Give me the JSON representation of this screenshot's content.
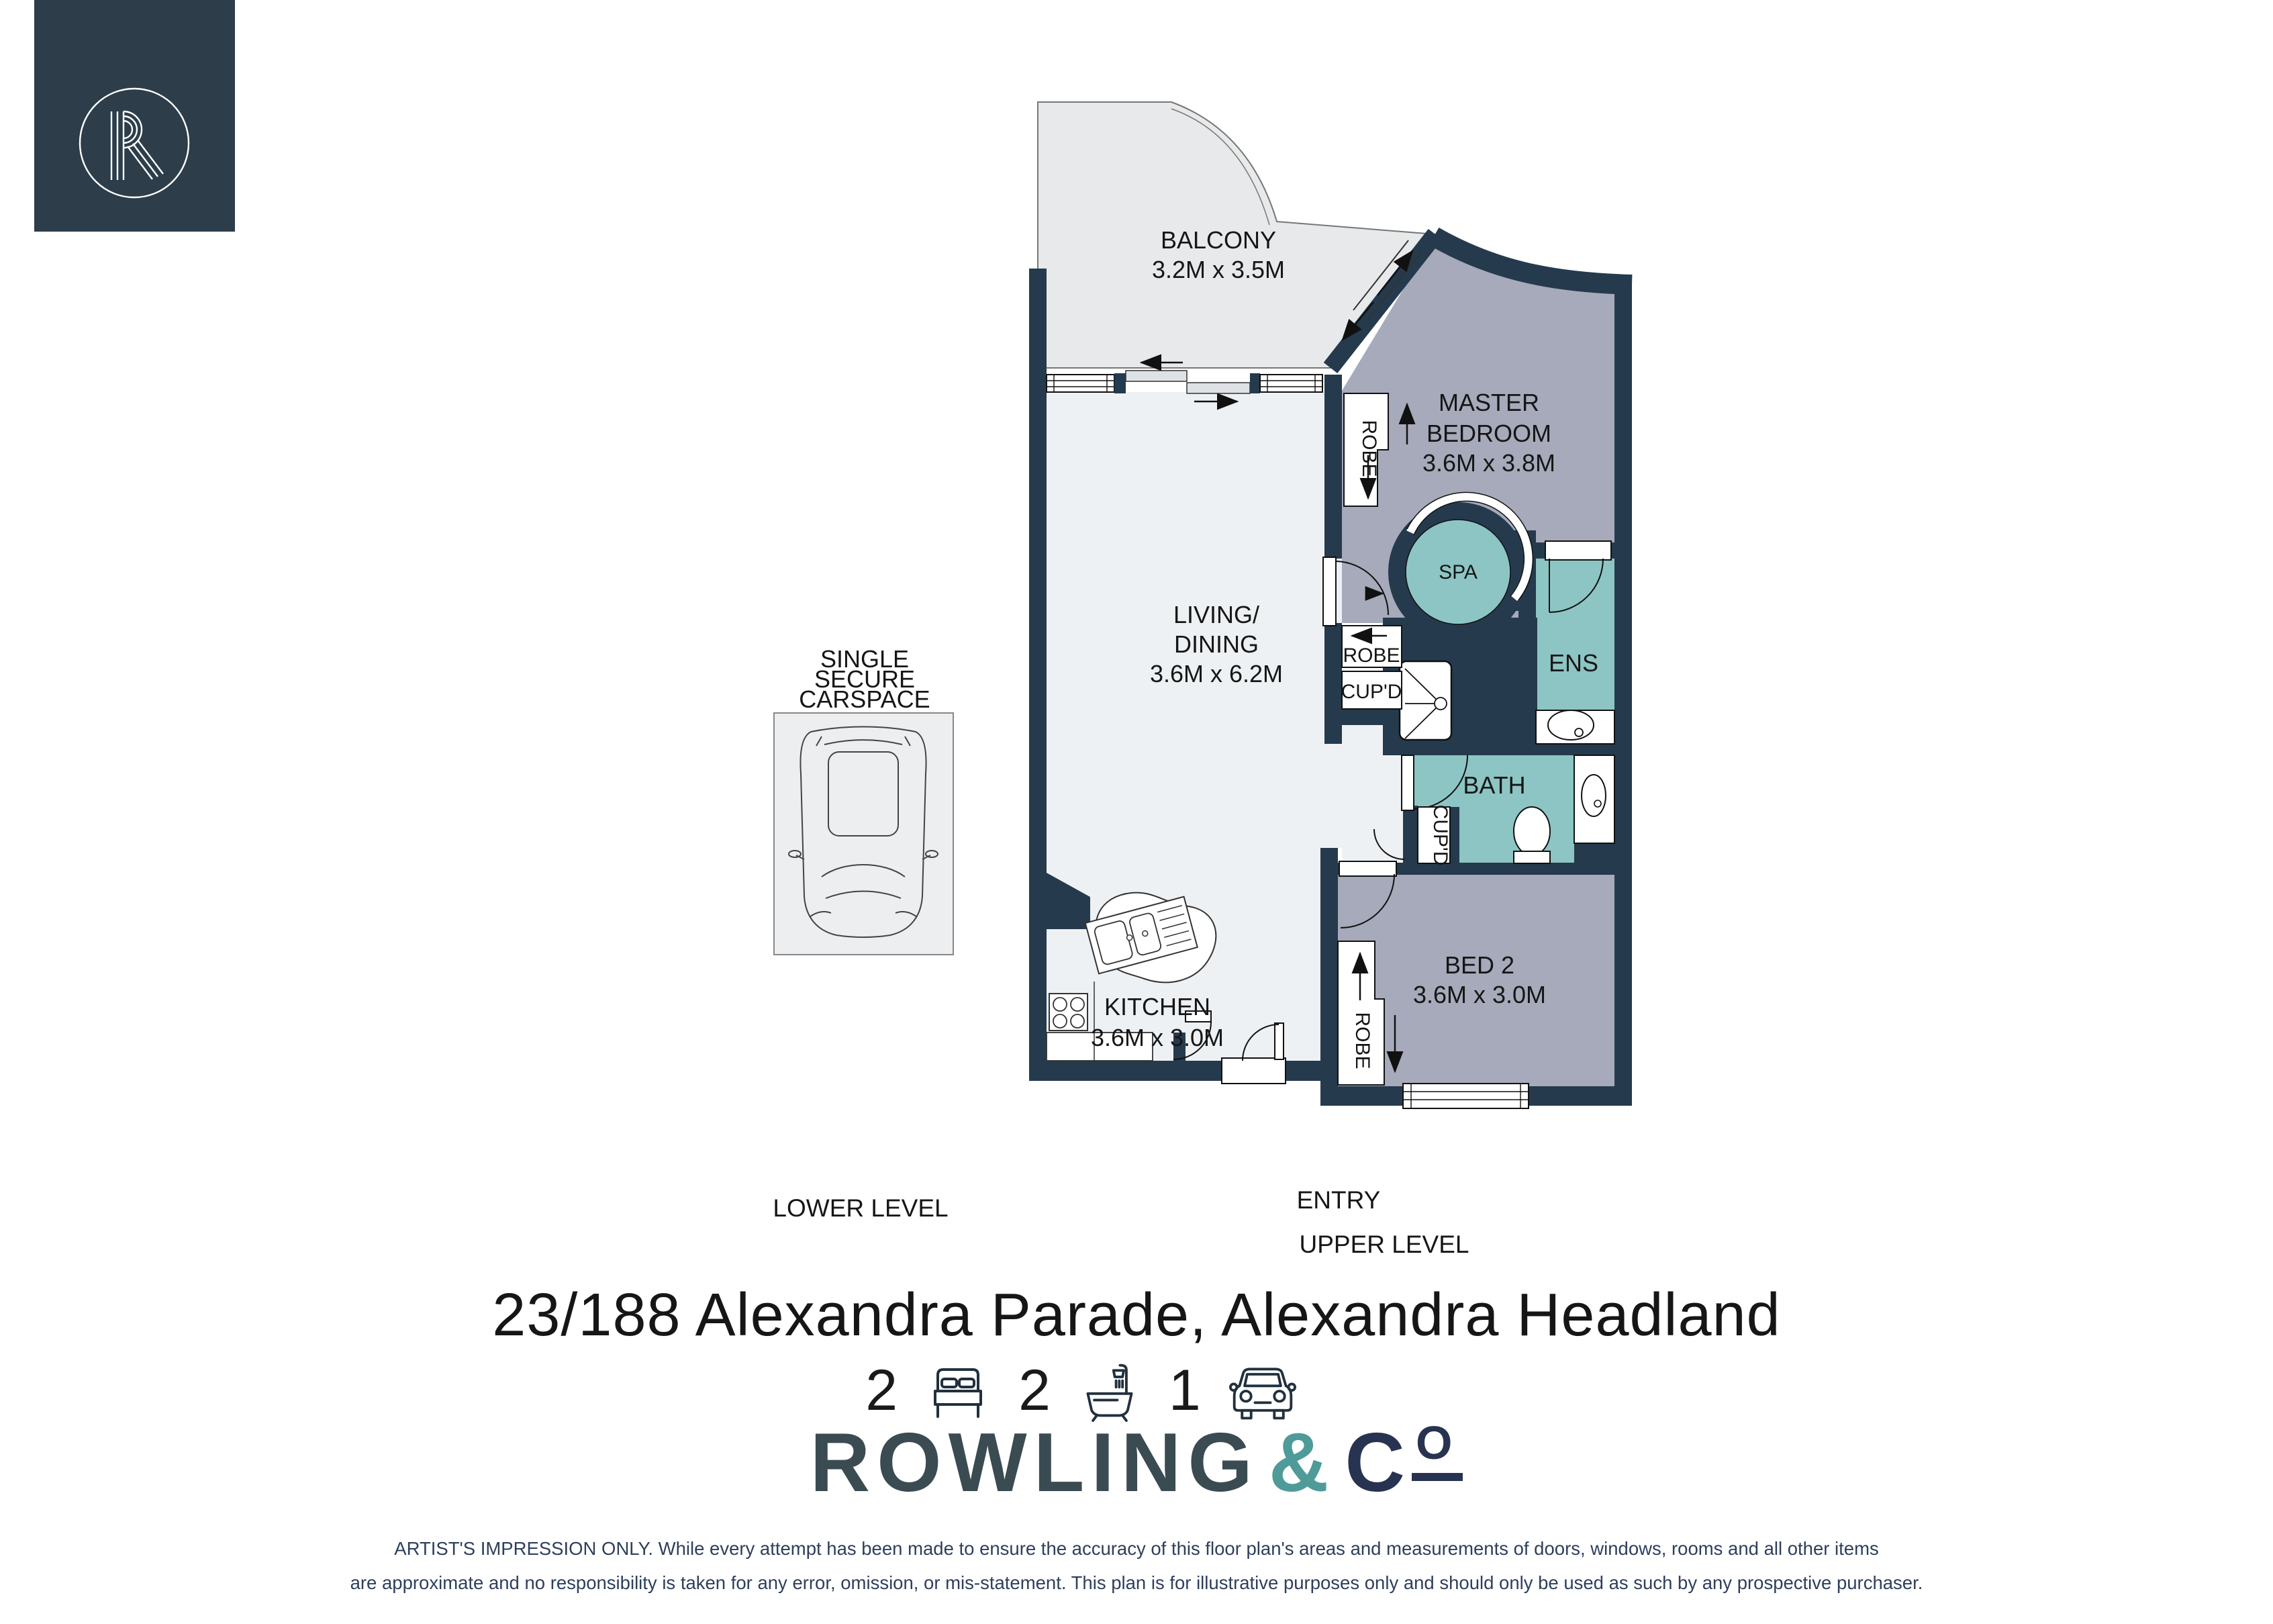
{
  "brand": {
    "logo_letter": "R",
    "wordmark": {
      "primary": "ROWLING",
      "ampersand": "&",
      "c": "C",
      "o": "O"
    }
  },
  "address": "23/188 Alexandra Parade, Alexandra Headland",
  "stats": {
    "beds": {
      "value": "2",
      "icon": "bed-icon"
    },
    "baths": {
      "value": "2",
      "icon": "bath-icon"
    },
    "cars": {
      "value": "1",
      "icon": "car-icon"
    }
  },
  "floor_plan": {
    "rooms": {
      "balcony": {
        "name": "BALCONY",
        "dims": "3.2M x 3.5M"
      },
      "living_dining": {
        "name_line1": "LIVING/",
        "name_line2": "DINING",
        "dims": "3.6M x 6.2M"
      },
      "master_bedroom": {
        "name_line1": "MASTER",
        "name_line2": "BEDROOM",
        "dims": "3.6M x 3.8M"
      },
      "spa": {
        "name": "SPA"
      },
      "ensuite": {
        "name": "ENS"
      },
      "bathroom": {
        "name": "BATH"
      },
      "bed2": {
        "name": "BED 2",
        "dims": "3.6M x 3.0M"
      },
      "kitchen": {
        "name": "KITCHEN",
        "dims": "3.6M x 3.0M"
      }
    },
    "storage": {
      "robe_master": "ROBE",
      "robe_hall": "ROBE",
      "cupd_hall": "CUP'D",
      "cupd_bath": "CUP'D",
      "robe_bed2": "ROBE"
    },
    "annotations": {
      "entry": "ENTRY",
      "upper_level": "UPPER LEVEL",
      "lower_level": "LOWER LEVEL",
      "carspace_line1": "SINGLE",
      "carspace_line2": "SECURE",
      "carspace_line3": "CARSPACE"
    },
    "colors": {
      "wall": "#253a4d",
      "balcony": "#e7e9ea",
      "living": "#eef1f3",
      "bedroom": "#a6aaba",
      "wet_area": "#8cc5c4",
      "fixture": "#ffffff",
      "logo_box": "#2d3d4a"
    }
  },
  "disclaimer": {
    "line1": "ARTIST'S IMPRESSION ONLY. While every attempt has been made to ensure the accuracy of this floor plan's areas and measurements of doors, windows, rooms and all other items",
    "line2": "are approximate and no responsibility is taken for any error, omission, or mis-statement. This plan is for illustrative purposes only and should only be used as such by any prospective purchaser."
  }
}
